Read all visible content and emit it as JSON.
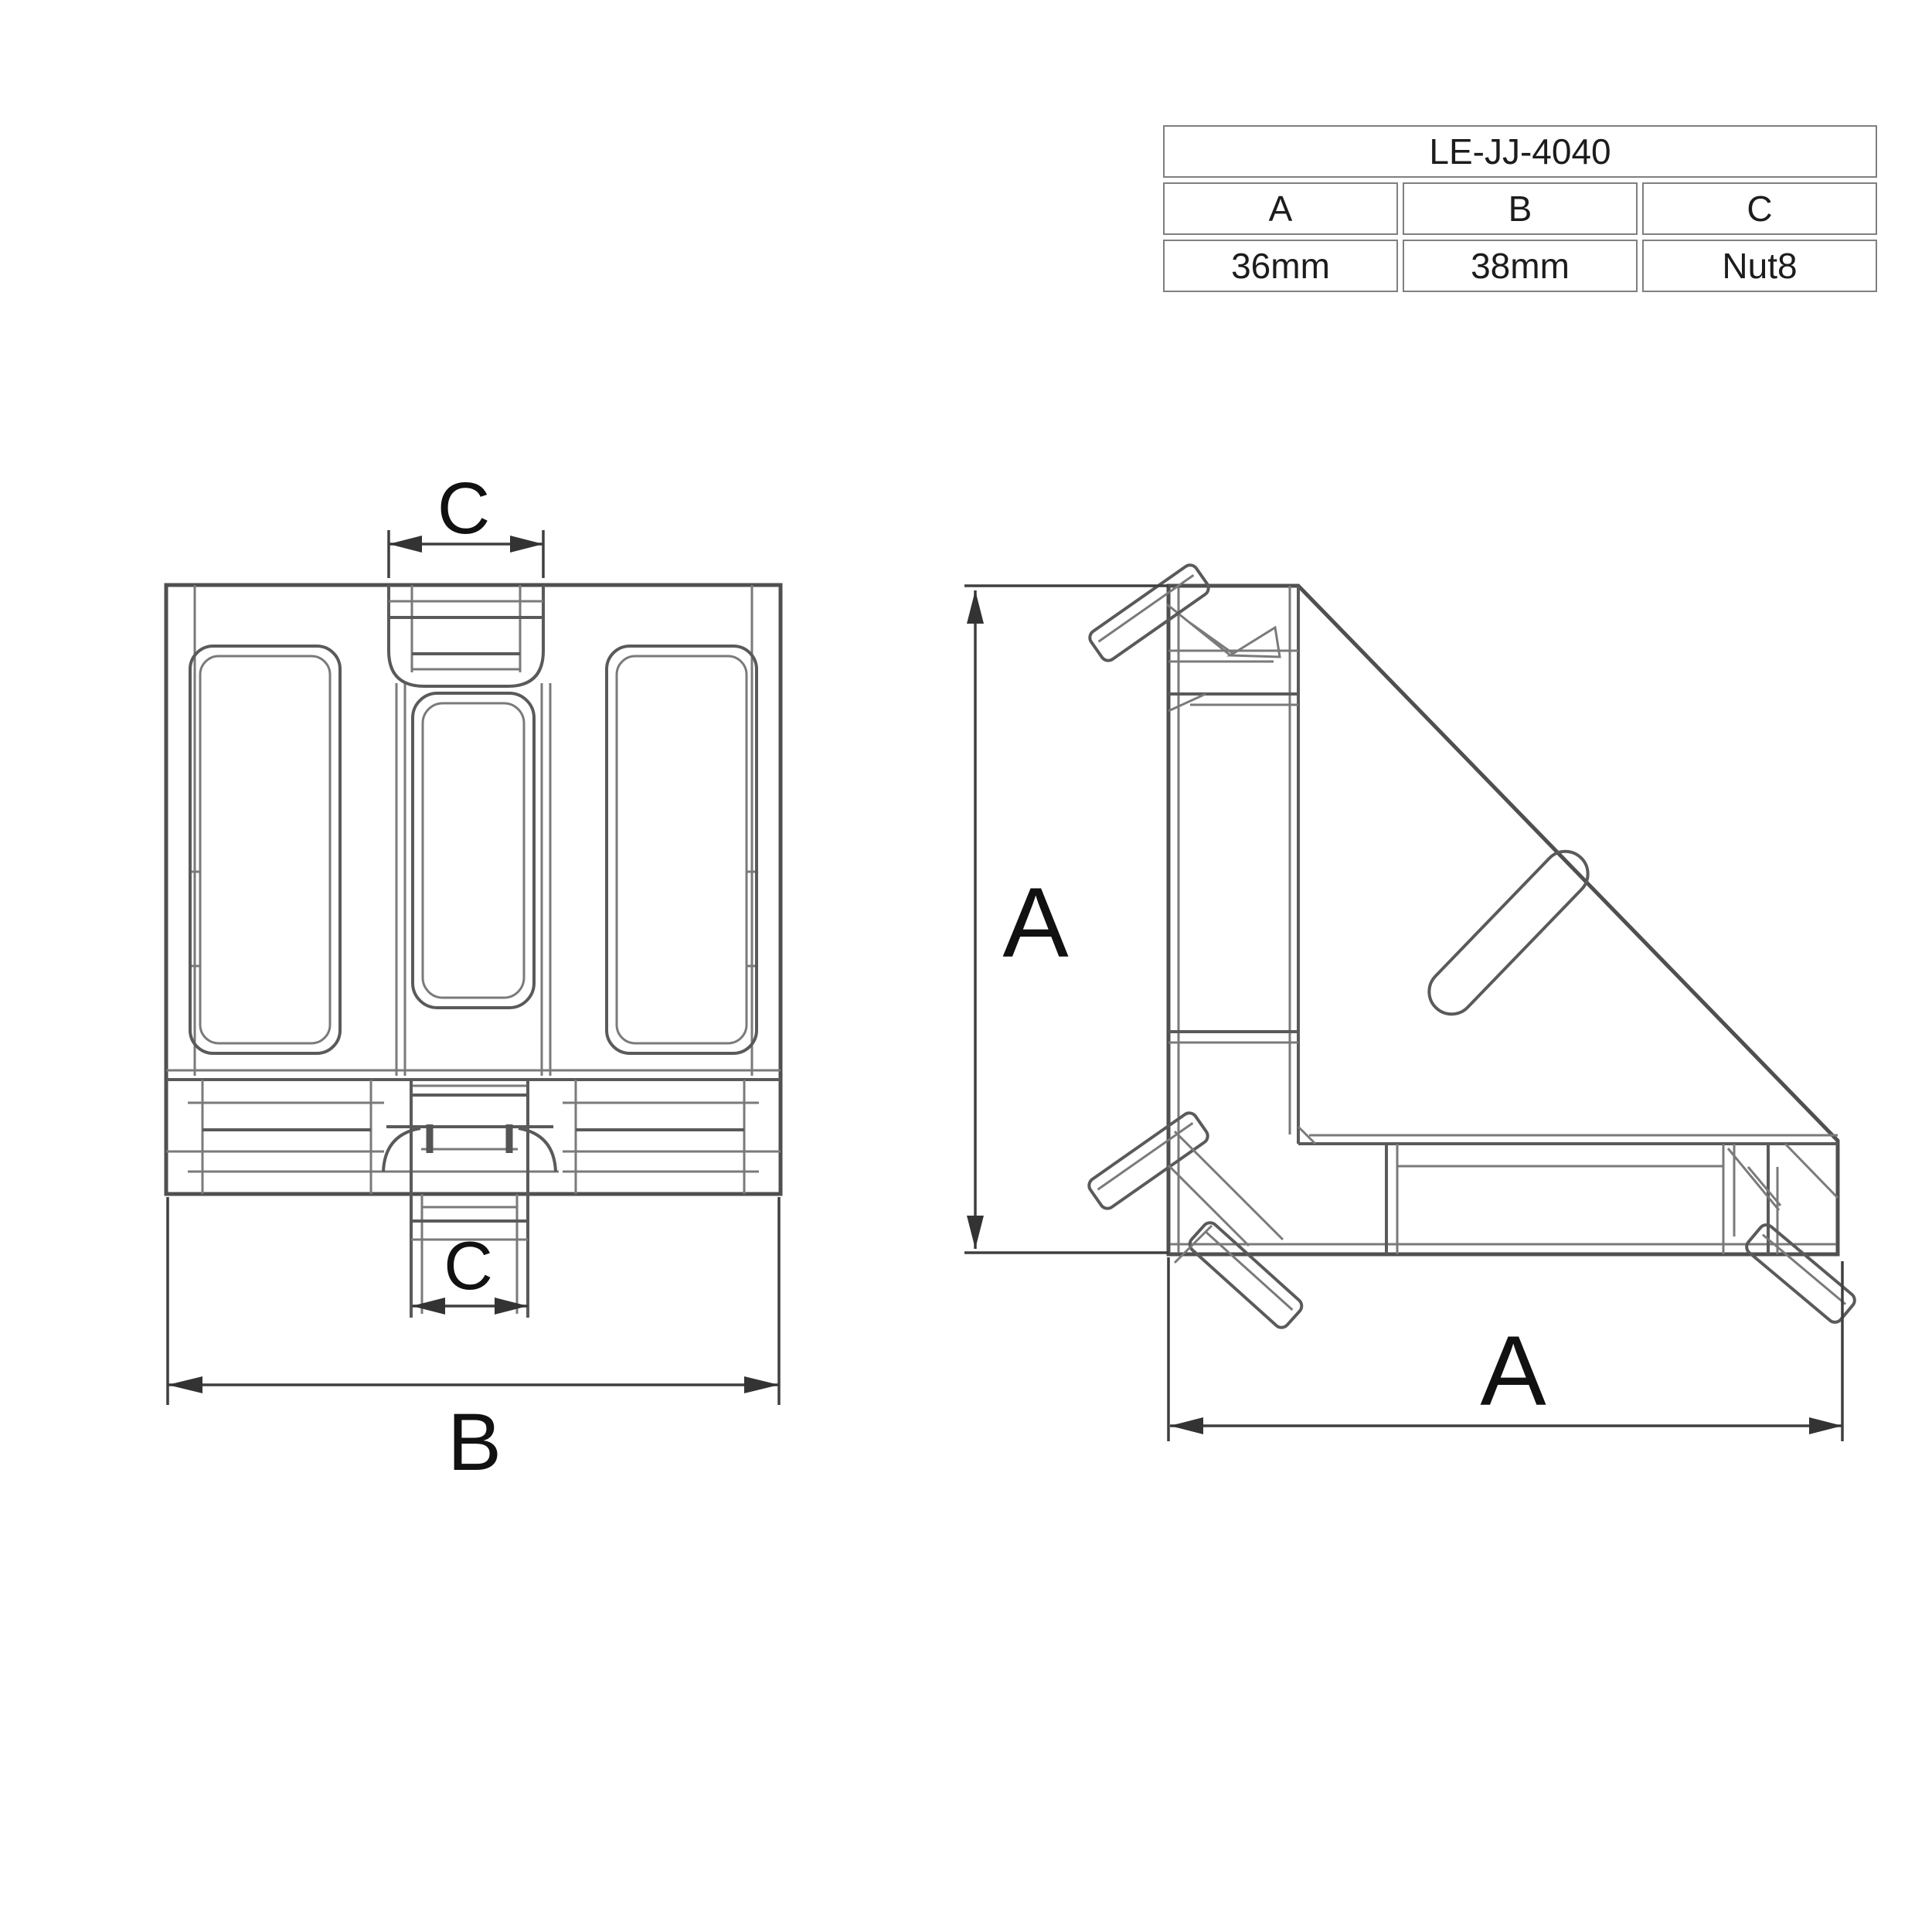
{
  "spec_table": {
    "model": "LE-JJ-4040",
    "columns": [
      {
        "header": "A",
        "value": "36mm"
      },
      {
        "header": "B",
        "value": "38mm"
      },
      {
        "header": "C",
        "value": "Nut8"
      }
    ]
  },
  "front_view": {
    "top_slot_label": "C",
    "bottom_slot_label": "C",
    "width_label": "B"
  },
  "side_view": {
    "height_label": "A",
    "width_label": "A"
  },
  "colors": {
    "background": "#ffffff",
    "line_main": "#4f4f4f",
    "line_detail": "#7a7a7a",
    "dimension_line": "#3f3f3f",
    "table_border": "#7f7f7f",
    "text": "#1c1c1c"
  }
}
